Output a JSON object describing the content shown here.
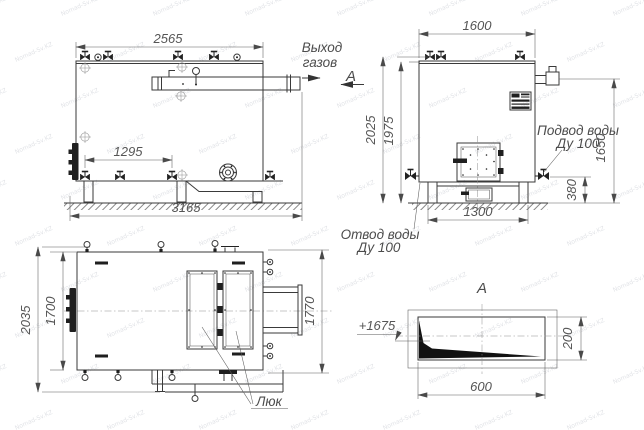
{
  "meta": {
    "type": "boiler-technical-drawing",
    "background_color": "#ffffff",
    "line_color": "#3a3a3a",
    "dim_text_color": "#555555"
  },
  "side_view": {
    "dim_top_width": "2565",
    "dim_nozzle_spacing": "1295",
    "dim_overall_length": "3165",
    "gas_outlet_line1": "Выход",
    "gas_outlet_line2": "газов",
    "section_arrow_label": "А"
  },
  "front_view": {
    "dim_top_width": "1600",
    "dim_overall_height": "2025",
    "dim_body_height": "1975",
    "dim_gas_duct_height": "1650",
    "dim_drain_height": "380",
    "dim_base_width": "1300",
    "water_supply_line1": "Подвод воды",
    "water_supply_line2": "Ду 100",
    "water_return_line1": "Отвод воды",
    "water_return_line2": "Ду 100"
  },
  "plan_view": {
    "dim_overall_depth": "2035",
    "dim_body_depth": "1700",
    "dim_right_depth": "1770",
    "hatch_label": "Люк"
  },
  "section_view": {
    "title": "А",
    "level_mark": "+1675",
    "dim_height": "200",
    "dim_width": "600"
  },
  "watermark": {
    "text": "Nomad-Sv.KZ"
  }
}
